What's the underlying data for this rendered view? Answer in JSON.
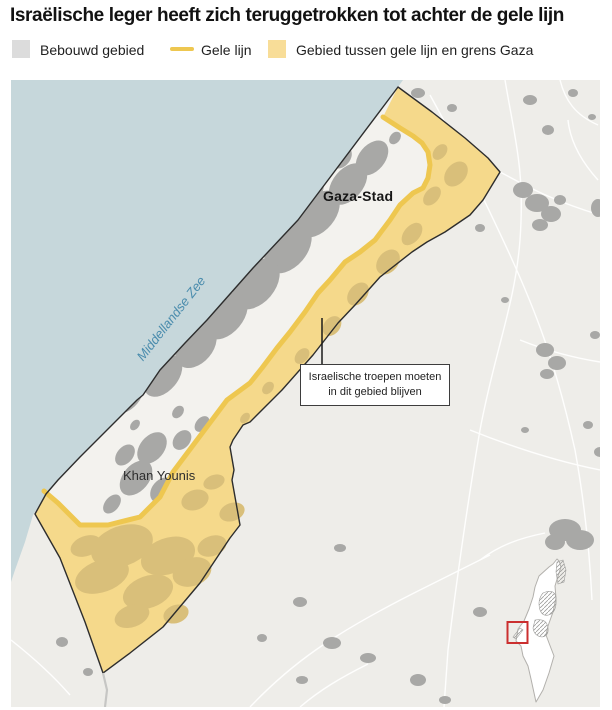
{
  "title": "Israëlische leger heeft zich teruggetrokken tot achter de gele lijn",
  "legend": {
    "items": [
      {
        "label": "Bebouwd gebied",
        "swatch": "gray-square",
        "color": "#dcdcdc"
      },
      {
        "label": "Gele lijn",
        "swatch": "yellow-line",
        "color": "#eec750"
      },
      {
        "label": "Gebied tussen gele lijn en grens Gaza",
        "swatch": "yellow-square",
        "color": "#f8dd98"
      }
    ]
  },
  "map": {
    "labels": {
      "sea": "Middellandse Zee",
      "city_north": "Gaza-Stad",
      "city_south": "Khan Younis"
    },
    "annotation": {
      "line1": "Israelische troepen moeten",
      "line2": "in dit gebied blijven"
    },
    "colors": {
      "sea": "#c6d7db",
      "land_outside": "#eeede9",
      "land_gaza": "#f3f2ee",
      "built_up": "#a8a8a6",
      "built_up_in_zone": "#d9bf7a",
      "yellow_zone": "#f5d98b",
      "yellow_line": "#eec750",
      "gaza_border": "#2d2d2d",
      "inset_highlight_box": "#cb2f2f"
    }
  }
}
